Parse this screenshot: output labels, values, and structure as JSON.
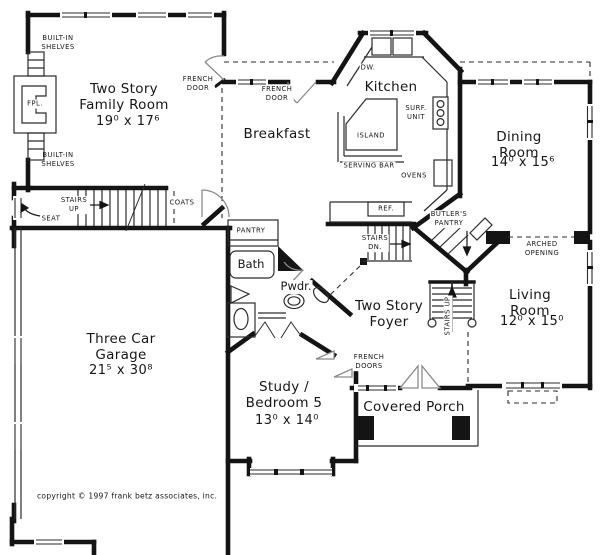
{
  "plan": {
    "rooms": {
      "family_room": {
        "name": "Two Story\nFamily Room",
        "dims": "19⁰ x 17⁶"
      },
      "breakfast": {
        "name": "Breakfast"
      },
      "kitchen": {
        "name": "Kitchen"
      },
      "dining_room": {
        "name": "Dining Room",
        "dims": "14⁰ x 15⁶"
      },
      "living_room": {
        "name": "Living Room",
        "dims": "12⁰ x 15⁰"
      },
      "foyer": {
        "name": "Two Story\nFoyer"
      },
      "study": {
        "name": "Study /\nBedroom 5",
        "dims": "13⁰ x 14⁰"
      },
      "garage": {
        "name": "Three Car\nGarage",
        "dims": "21⁵ x 30⁸"
      },
      "covered_porch": {
        "name": "Covered Porch"
      }
    },
    "labels": {
      "built_in_shelves_top": "BUILT-IN\nSHELVES",
      "built_in_shelves_bottom": "BUILT-IN\nSHELVES",
      "fireplace": "FPL.",
      "french_door_family": "FRENCH\nDOOR",
      "french_door_breakfast": "FRENCH\nDOOR",
      "french_doors_study": "FRENCH\nDOORS",
      "dishwasher": "DW.",
      "surface_unit": "SURF.\nUNIT",
      "island": "ISLAND",
      "serving_bar": "SERVING BAR",
      "ovens": "OVENS",
      "refrigerator": "REF.",
      "butlers_pantry": "BUTLER'S\nPANTRY",
      "stairs_up_hall": "STAIRS\nUP",
      "stairs_dn": "STAIRS\nDN.",
      "stairs_up_foyer": "STAIRS UP",
      "seat": "SEAT",
      "coats": "COATS",
      "pantry": "PANTRY",
      "bath": "Bath",
      "powder": "Pwdr.",
      "arched_opening": "ARCHED OPENING"
    },
    "footer": {
      "copyright": "copyright © 1997 frank betz associates, inc."
    },
    "colors": {
      "wall": "#141414",
      "line": "#2b2b2b",
      "door": "#8a8a8a",
      "background": "#ffffff"
    }
  }
}
